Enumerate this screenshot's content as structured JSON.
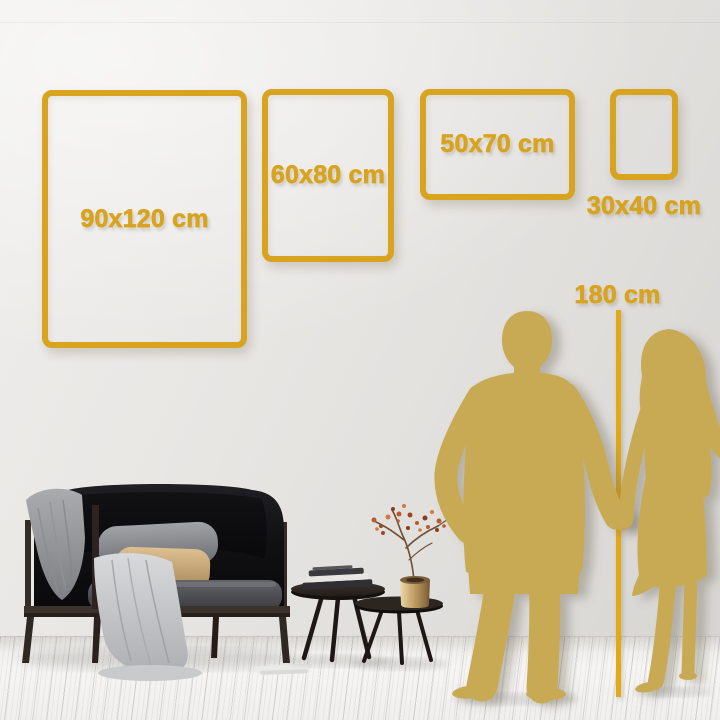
{
  "size_guide": {
    "frames": [
      {
        "id": "90x120",
        "label": "90x120 cm",
        "orientation": "portrait"
      },
      {
        "id": "60x80",
        "label": "60x80 cm",
        "orientation": "portrait"
      },
      {
        "id": "50x70",
        "label": "50x70 cm",
        "orientation": "landscape"
      },
      {
        "id": "30x40",
        "label": "30x40 cm",
        "orientation": "portrait",
        "label_position": "below-frame"
      }
    ],
    "height_reference": {
      "label": "180 cm"
    }
  },
  "colors": {
    "frame_gold": "#D8A31E",
    "ruler_gold": "#E2A815",
    "silhouette_gold": "#C8AA54",
    "wall": "#E4E2DF",
    "floor": "#F4F3F1"
  },
  "scene": {
    "silhouettes": [
      "man",
      "woman-holding-hands"
    ],
    "furniture": [
      "black-velvet-sofa",
      "gray-blanket",
      "gray-pillow",
      "beige-pillow",
      "white-throw-fabric",
      "nesting-coffee-tables",
      "stacked-books",
      "brass-vase-with-dried-branch"
    ]
  }
}
